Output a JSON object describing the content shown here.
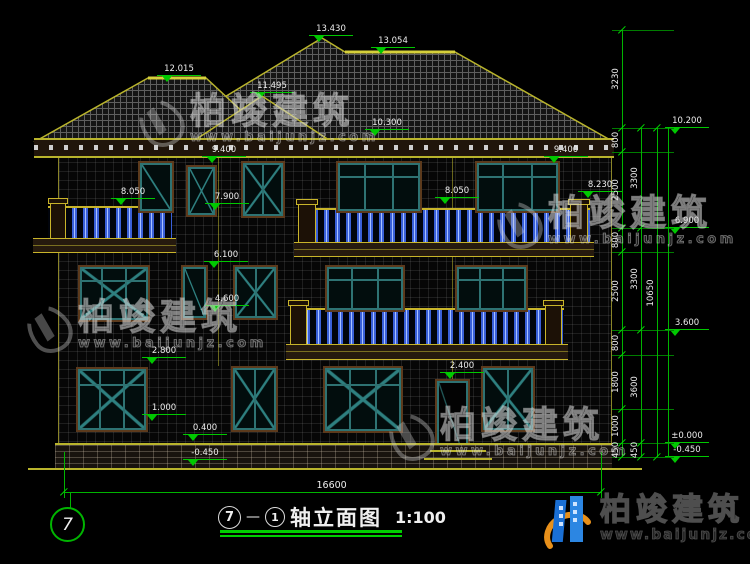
{
  "title": {
    "axis_a": "7",
    "dash": "—",
    "axis_b": "1",
    "name": "轴立面图",
    "scale": "1:100"
  },
  "axis_bubble": "7",
  "brand": {
    "name": "柏竣建筑",
    "url": "www.baijunjz.com"
  },
  "watermark": {
    "text": "柏竣建筑",
    "url": "www.baijunjz.com",
    "positions": [
      {
        "x": 140,
        "y": 94
      },
      {
        "x": 498,
        "y": 196
      },
      {
        "x": 28,
        "y": 300
      },
      {
        "x": 390,
        "y": 408
      }
    ]
  },
  "colors": {
    "dim_green": "#00c800",
    "line_yellow": "#b9b42c",
    "frame_teal": "#2e7272",
    "baluster_blue": "#3a60d8",
    "brand_blue": "#1a6fd4",
    "brand_orange": "#e8901a"
  },
  "annotations": {
    "inside_markers": [
      {
        "label": "13.430",
        "x": 322,
        "y": 36
      },
      {
        "label": "13.054",
        "x": 384,
        "y": 48
      },
      {
        "label": "12.015",
        "x": 170,
        "y": 76
      },
      {
        "label": "11.495",
        "x": 263,
        "y": 93
      },
      {
        "label": "10.300",
        "x": 378,
        "y": 130
      },
      {
        "label": "9.400",
        "x": 215,
        "y": 157
      },
      {
        "label": "9.400",
        "x": 557,
        "y": 157
      },
      {
        "label": "8.050",
        "x": 124,
        "y": 199
      },
      {
        "label": "8.050",
        "x": 448,
        "y": 198
      },
      {
        "label": "8.230",
        "x": 591,
        "y": 192
      },
      {
        "label": "7.900",
        "x": 218,
        "y": 204
      },
      {
        "label": "6.100",
        "x": 217,
        "y": 262
      },
      {
        "label": "4.600",
        "x": 218,
        "y": 306
      },
      {
        "label": "2.800",
        "x": 155,
        "y": 358
      },
      {
        "label": "2.400",
        "x": 453,
        "y": 373
      },
      {
        "label": "1.000",
        "x": 155,
        "y": 415
      },
      {
        "label": "0.400",
        "x": 196,
        "y": 435
      },
      {
        "label": "-0.450",
        "x": 196,
        "y": 460
      }
    ],
    "right_markers": [
      {
        "label": "10.200",
        "y": 128
      },
      {
        "label": "6.900",
        "y": 228
      },
      {
        "label": "3.600",
        "y": 330
      },
      {
        "label": "±0.000",
        "y": 443
      },
      {
        "label": "-0.450",
        "y": 457
      }
    ],
    "chains": [
      {
        "x": 622,
        "segments": [
          {
            "label": "3230",
            "a": 30,
            "b": 128
          },
          {
            "label": "800",
            "a": 128,
            "b": 152
          },
          {
            "label": "2500",
            "a": 152,
            "b": 228
          },
          {
            "label": "800",
            "a": 228,
            "b": 252
          },
          {
            "label": "2500",
            "a": 252,
            "b": 330
          },
          {
            "label": "800",
            "a": 330,
            "b": 355
          },
          {
            "label": "1800",
            "a": 355,
            "b": 409
          },
          {
            "label": "1000",
            "a": 409,
            "b": 443
          },
          {
            "label": "450",
            "a": 443,
            "b": 457
          }
        ]
      },
      {
        "x": 641,
        "segments": [
          {
            "label": "3300",
            "a": 128,
            "b": 228
          },
          {
            "label": "3300",
            "a": 228,
            "b": 330
          },
          {
            "label": "3600",
            "a": 330,
            "b": 443
          },
          {
            "label": "450",
            "a": 443,
            "b": 457
          }
        ]
      },
      {
        "x": 657,
        "segments": [
          {
            "label": "10650",
            "a": 128,
            "b": 457
          }
        ]
      }
    ],
    "extension_ys": [
      30,
      128,
      152,
      228,
      252,
      330,
      355,
      409,
      443,
      457
    ],
    "elevation_vline": {
      "x": 668,
      "a": 128,
      "b": 457
    },
    "bottom_dim": {
      "label": "16600",
      "x1": 64,
      "x2": 601,
      "y": 492,
      "ext_top": 452,
      "ext_bottom": 498
    }
  }
}
